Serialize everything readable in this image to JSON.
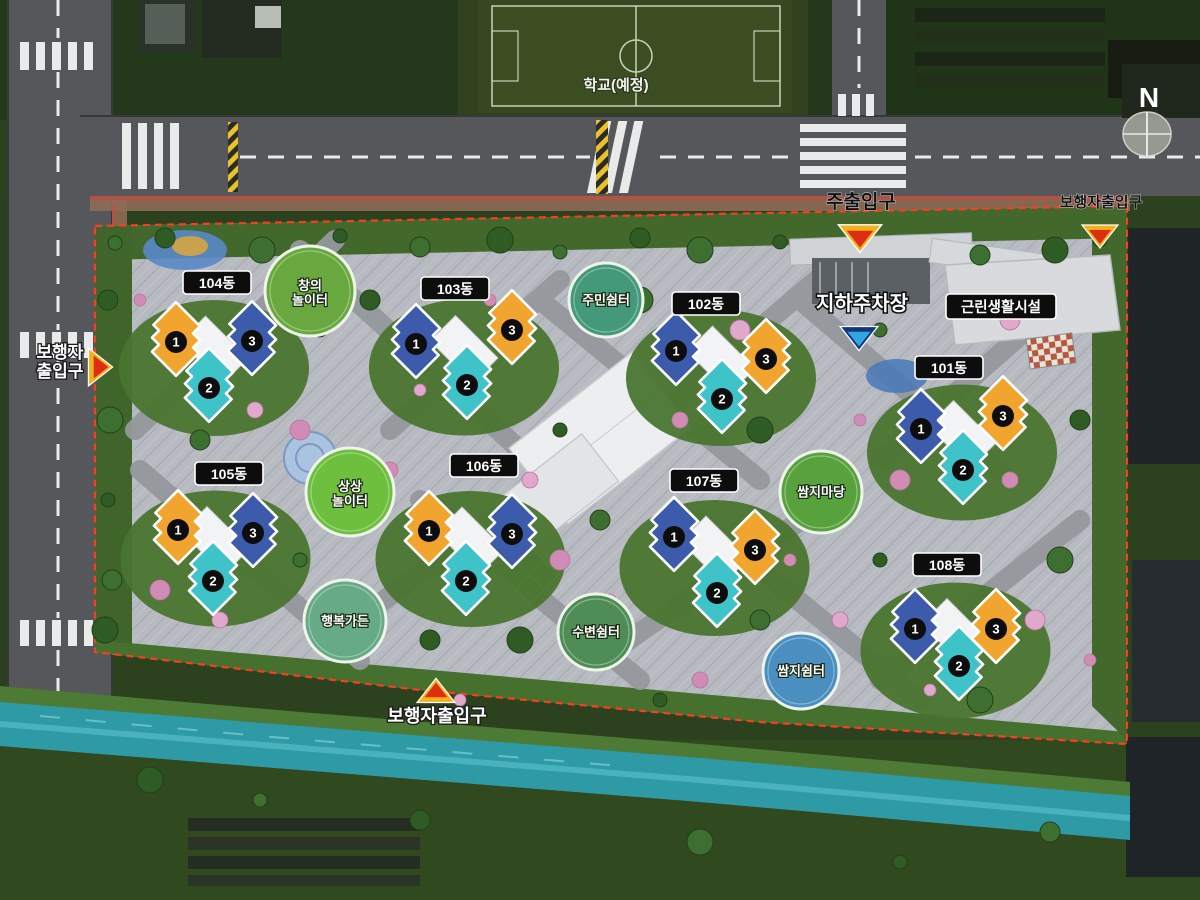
{
  "compass": {
    "label": "N",
    "x": 1149,
    "y": 99
  },
  "school": {
    "label": "학교(예정)",
    "x": 616,
    "y": 90
  },
  "colors": {
    "unit_orange": "#F2A52E",
    "unit_teal": "#3EC3C8",
    "unit_blue": "#3C5CAB",
    "boundary_red": "#FF3B20",
    "water": "#2D9AA6",
    "label_box": "#0D0D0D"
  },
  "facilities": [
    {
      "id": "underground-parking",
      "label": "지하주차장",
      "x": 862,
      "y": 310,
      "arrow": "down",
      "scheme": "blue",
      "ax": 859,
      "ay": 338
    },
    {
      "id": "neighborhood-facility",
      "label": "근린생활시설",
      "x": 1001,
      "y": 307,
      "boxed": true
    }
  ],
  "entrances": [
    {
      "id": "main-entrance",
      "label": "주출입구",
      "x": 861,
      "y": 208,
      "style": "dark",
      "size": 19,
      "arrow": "down",
      "scheme": "redYellow",
      "ax": 860,
      "ay": 238,
      "ascale": 1.2
    },
    {
      "id": "pedestrian-entrance-top-right",
      "label": "보행자출입구",
      "x": 1101,
      "y": 207,
      "style": "dark",
      "size": 15,
      "arrow": "down",
      "scheme": "redYellow",
      "ax": 1100,
      "ay": 236,
      "ascale": 1
    },
    {
      "id": "pedestrian-entrance-left",
      "label": "보행자\n출입구",
      "x": 60,
      "y": 358,
      "style": "light",
      "size": 17,
      "arrow": "right",
      "scheme": "redYellow",
      "ax": 100,
      "ay": 367,
      "ascale": 1.05
    },
    {
      "id": "pedestrian-entrance-bottom",
      "label": "보행자출입구",
      "x": 437,
      "y": 722,
      "style": "light",
      "size": 18,
      "arrow": "up",
      "scheme": "redYellow",
      "ax": 436,
      "ay": 691,
      "ascale": 1.05
    }
  ],
  "clusters": [
    {
      "label": "104동",
      "lx": 217,
      "ly": 283,
      "buildings": [
        {
          "num": "1",
          "color": "orange",
          "x": 176,
          "y": 339
        },
        {
          "num": "2",
          "color": "teal",
          "x": 209,
          "y": 385
        },
        {
          "num": "3",
          "color": "blue",
          "x": 252,
          "y": 338
        }
      ]
    },
    {
      "label": "103동",
      "lx": 455,
      "ly": 289,
      "buildings": [
        {
          "num": "1",
          "color": "blue",
          "x": 416,
          "y": 341
        },
        {
          "num": "2",
          "color": "teal",
          "x": 467,
          "y": 382
        },
        {
          "num": "3",
          "color": "orange",
          "x": 512,
          "y": 327
        }
      ]
    },
    {
      "label": "102동",
      "lx": 706,
      "ly": 304,
      "buildings": [
        {
          "num": "1",
          "color": "blue",
          "x": 676,
          "y": 348
        },
        {
          "num": "2",
          "color": "teal",
          "x": 722,
          "y": 396
        },
        {
          "num": "3",
          "color": "orange",
          "x": 766,
          "y": 356
        }
      ]
    },
    {
      "label": "101동",
      "lx": 949,
      "ly": 368,
      "buildings": [
        {
          "num": "1",
          "color": "blue",
          "x": 921,
          "y": 426
        },
        {
          "num": "2",
          "color": "teal",
          "x": 963,
          "y": 467
        },
        {
          "num": "3",
          "color": "orange",
          "x": 1003,
          "y": 413
        }
      ]
    },
    {
      "label": "105동",
      "lx": 229,
      "ly": 474,
      "buildings": [
        {
          "num": "1",
          "color": "orange",
          "x": 178,
          "y": 527
        },
        {
          "num": "2",
          "color": "teal",
          "x": 213,
          "y": 578
        },
        {
          "num": "3",
          "color": "blue",
          "x": 253,
          "y": 530
        }
      ]
    },
    {
      "label": "106동",
      "lx": 484,
      "ly": 466,
      "buildings": [
        {
          "num": "1",
          "color": "orange",
          "x": 429,
          "y": 528
        },
        {
          "num": "2",
          "color": "teal",
          "x": 466,
          "y": 578
        },
        {
          "num": "3",
          "color": "blue",
          "x": 512,
          "y": 531
        }
      ]
    },
    {
      "label": "107동",
      "lx": 704,
      "ly": 481,
      "buildings": [
        {
          "num": "1",
          "color": "blue",
          "x": 674,
          "y": 534
        },
        {
          "num": "2",
          "color": "teal",
          "x": 717,
          "y": 590
        },
        {
          "num": "3",
          "color": "orange",
          "x": 755,
          "y": 547
        }
      ]
    },
    {
      "label": "108동",
      "lx": 947,
      "ly": 565,
      "buildings": [
        {
          "num": "1",
          "color": "blue",
          "x": 915,
          "y": 626
        },
        {
          "num": "2",
          "color": "teal",
          "x": 959,
          "y": 663
        },
        {
          "num": "3",
          "color": "orange",
          "x": 996,
          "y": 626
        }
      ]
    }
  ],
  "amenities": [
    {
      "id": "changui-playground",
      "label": "창의\n놀이터",
      "x": 310,
      "y": 291,
      "r": 45,
      "fill": "#69A83E"
    },
    {
      "id": "jumin-shelter",
      "label": "주민쉼터",
      "x": 606,
      "y": 300,
      "r": 37,
      "fill": "#44997B"
    },
    {
      "id": "sangsang-playground",
      "label": "상상\n놀이터",
      "x": 350,
      "y": 492,
      "r": 44,
      "fill": "#6FBF3F"
    },
    {
      "id": "haengbok-garden",
      "label": "행복가든",
      "x": 345,
      "y": 621,
      "r": 41,
      "fill": "#66AA88"
    },
    {
      "id": "subyeon-shelter",
      "label": "수변쉼터",
      "x": 596,
      "y": 632,
      "r": 38,
      "fill": "#4E8D55"
    },
    {
      "id": "ssamji-yard",
      "label": "쌈지마당",
      "x": 821,
      "y": 492,
      "r": 41,
      "fill": "#58A23E"
    },
    {
      "id": "ssamji-shelter",
      "label": "쌈지쉼터",
      "x": 801,
      "y": 671,
      "r": 38,
      "fill": "#4A8FC0"
    }
  ]
}
